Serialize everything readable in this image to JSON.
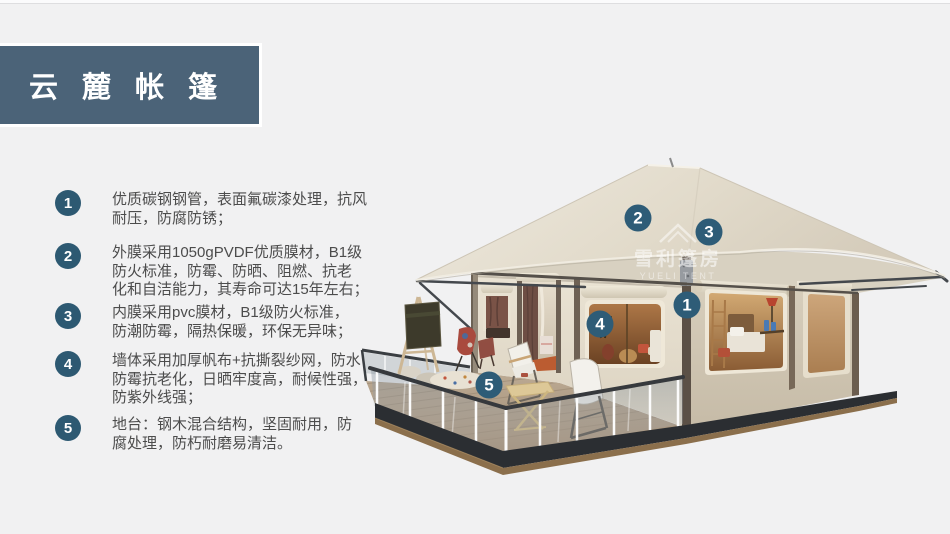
{
  "slide": {
    "title": "云 麓 帐 篷",
    "features": [
      {
        "num": "1",
        "text": "优质碳钢钢管，表面氟碳漆处理，抗风\n耐压，防腐防锈；"
      },
      {
        "num": "2",
        "text": "外膜采用1050gPVDF优质膜材，B1级\n防火标准，防霉、防晒、阻燃、抗老\n化和自洁能力，其寿命可达15年左右；"
      },
      {
        "num": "3",
        "text": "内膜采用pvc膜材，B1级防火标准，\n防潮防霉，隔热保暖，环保无异味；"
      },
      {
        "num": "4",
        "text": "墙体采用加厚帆布+抗撕裂纱网，防水\n防霉抗老化，日晒牢度高，耐候性强，\n防紫外线强；"
      },
      {
        "num": "5",
        "text": "地台：钢木混合结构，坚固耐用，防\n腐处理，防朽耐磨易清洁。"
      }
    ],
    "markers": [
      {
        "num": "1"
      },
      {
        "num": "2"
      },
      {
        "num": "3"
      },
      {
        "num": "4"
      },
      {
        "num": "5"
      }
    ],
    "watermark": {
      "name": "雪利篷房",
      "name_en": "YUELI TENT"
    },
    "colors": {
      "accent": "#2d5972",
      "banner": "#4b6378",
      "background": "#f1f1f2"
    }
  }
}
